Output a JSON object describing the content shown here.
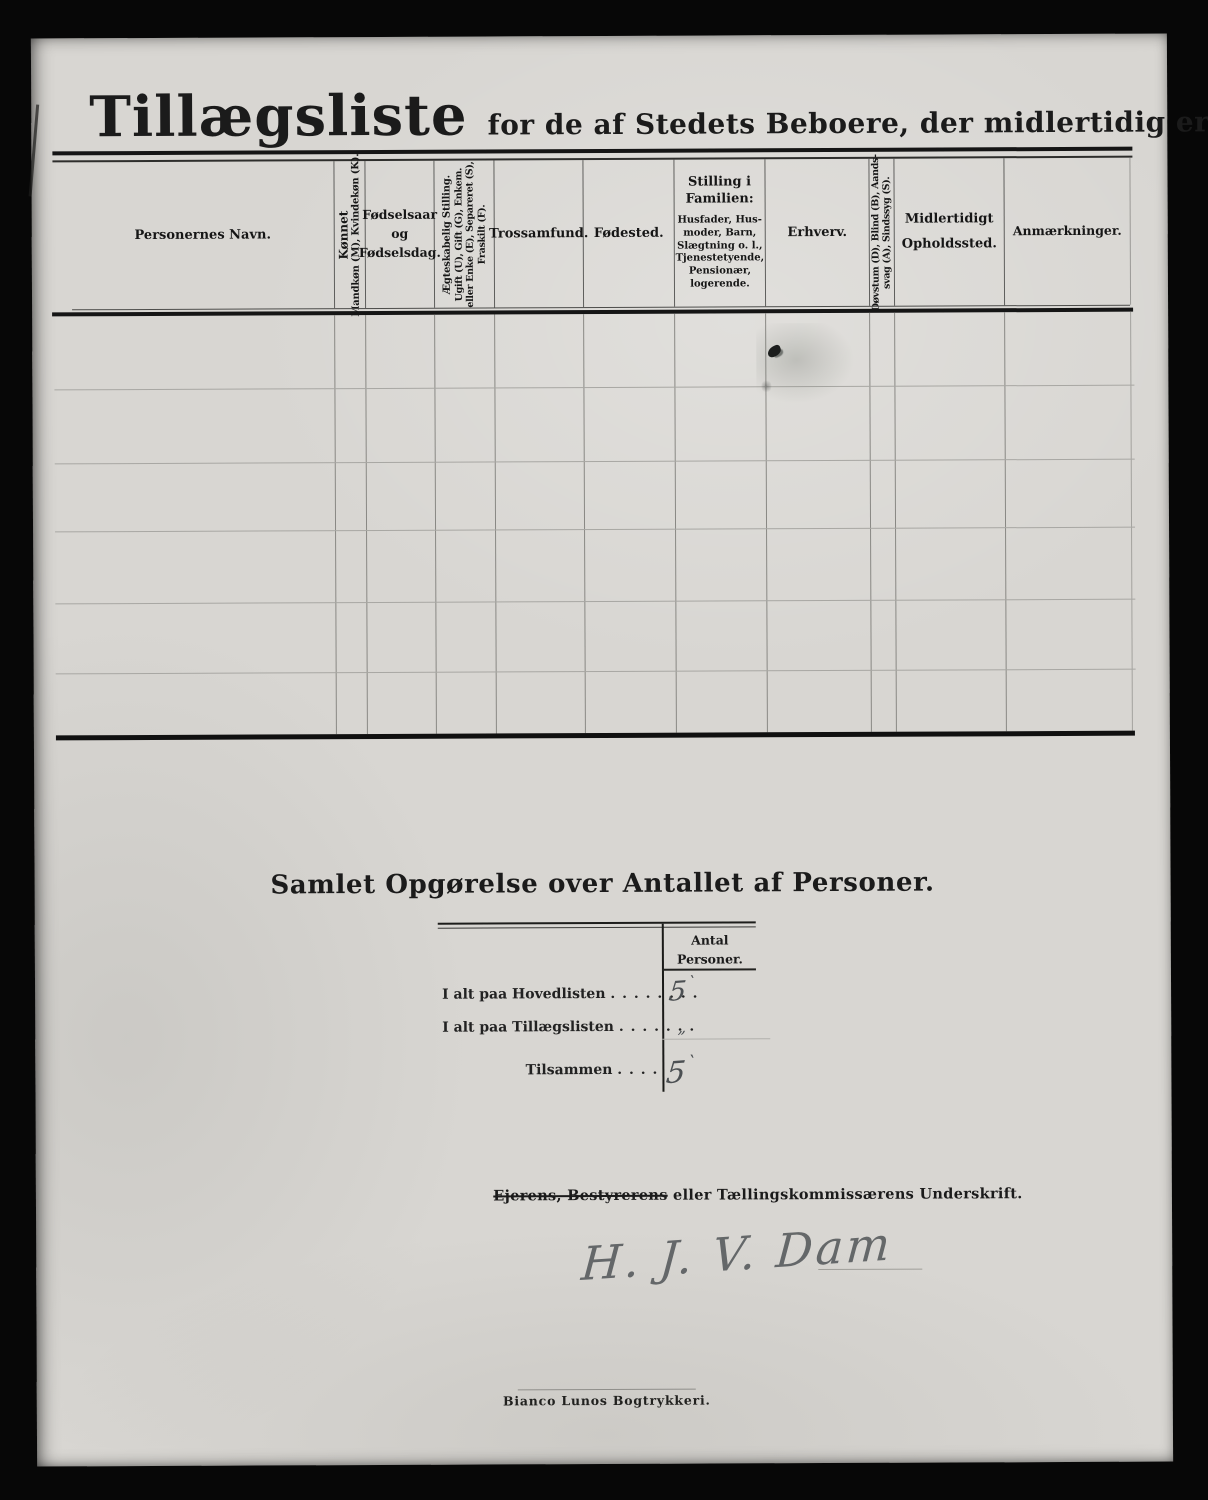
{
  "page_title": {
    "main": "Tillægsliste",
    "subtitle": "for de af Stedets Beboere, der midlertidig ere",
    "subtitle_emphasis": "fraværende."
  },
  "table": {
    "columns": [
      {
        "label": "Personernes Navn."
      },
      {
        "line1": "Kønnet",
        "line2": "Mandkøn (M), Kvindekøn (K)."
      },
      {
        "line1": "Fødselsaar",
        "line2": "og",
        "line3": "Fødselsdag."
      },
      {
        "line1": "Ægteskabelig Stilling.",
        "line2": "Ugift (U), Gift (G), Enkem.",
        "line3": "eller Enke (E), Separeret (S),",
        "line4": "Fraskilt (F)."
      },
      {
        "label": "Trossamfund."
      },
      {
        "label": "Fødested."
      },
      {
        "title1": "Stilling i",
        "title2": "Familien:",
        "line1": "Husfader, Hus-",
        "line2": "moder, Barn,",
        "line3": "Slægtning o. l.,",
        "line4": "Tjenestetyende,",
        "line5": "Pensionær,",
        "line6": "logerende."
      },
      {
        "label": "Erhverv."
      },
      {
        "line1": "Døvstum (D), Blind (B), Aands-",
        "line2": "svag (A), Sindssyg (S)."
      },
      {
        "line1": "Midlertidigt",
        "line2": "Opholdssted."
      },
      {
        "label": "Anmærkninger."
      }
    ],
    "body_row_count": 6
  },
  "summary": {
    "heading": "Samlet Opgørelse over Antallet af Personer.",
    "col_header_line1": "Antal",
    "col_header_line2": "Personer.",
    "rows": [
      {
        "label": "I alt paa Hovedlisten",
        "dots": ". . . . . . . .",
        "value": "5",
        "tick": "`"
      },
      {
        "label": "I alt paa Tillægslisten",
        "dots": ". . . . . . .",
        "value": "„",
        "tick": ""
      },
      {
        "label": "Tilsammen",
        "dots": ". . . .",
        "value": "5",
        "tick": "`"
      }
    ]
  },
  "signature": {
    "caption_struck": "Ejerens, Bestyrerens",
    "caption_rest": " eller Tællingskommissærens Underskrift.",
    "handwritten": "H. J. V. Dam"
  },
  "footer": {
    "imprint": "Bianco Lunos Bogtrykkeri."
  },
  "colors": {
    "background": "#070707",
    "paper": "#d8d6d2",
    "printed_ink": "#1b1b1b",
    "handwriting_ink": "#4c5053"
  }
}
